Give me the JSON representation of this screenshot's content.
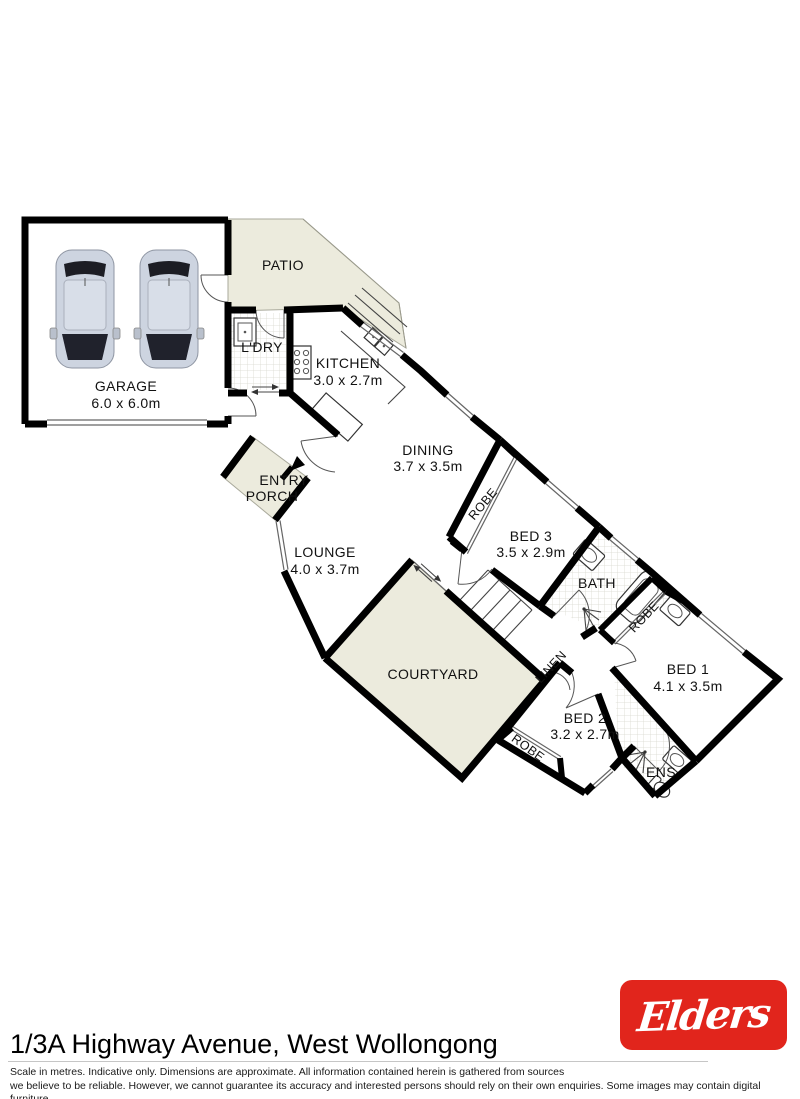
{
  "rooms": {
    "garage": {
      "name": "GARAGE",
      "dims": "6.0 x 6.0m"
    },
    "patio": {
      "name": "PATIO"
    },
    "laundry": {
      "name": "L'DRY"
    },
    "kitchen": {
      "name": "KITCHEN",
      "dims": "3.0 x 2.7m"
    },
    "dining": {
      "name": "DINING",
      "dims": "3.7 x 3.5m"
    },
    "entry_porch": {
      "line1": "ENTRY",
      "line2": "PORCH"
    },
    "lounge": {
      "name": "LOUNGE",
      "dims": "4.0 x 3.7m"
    },
    "courtyard": {
      "name": "COURTYARD"
    },
    "bed3": {
      "name": "BED 3",
      "dims": "3.5 x 2.9m"
    },
    "bath": {
      "name": "BATH"
    },
    "robe_bed3": {
      "name": "ROBE"
    },
    "robe_bed1": {
      "name": "ROBE"
    },
    "robe_bed2": {
      "name": "ROBE"
    },
    "linen": {
      "name": "LINEN"
    },
    "bed1": {
      "name": "BED 1",
      "dims": "4.1 x 3.5m"
    },
    "bed2": {
      "name": "BED 2",
      "dims": "3.2 x 2.7m"
    },
    "ensuite": {
      "name": "ENS"
    }
  },
  "icons": [
    "car",
    "laundry-sink",
    "stove",
    "kitchen-sink",
    "kitchen-bench",
    "bathtub",
    "shower",
    "vanity",
    "toilet",
    "stairs",
    "entry-arrow",
    "sliding-door-arrows"
  ],
  "footer": {
    "address": "1/3A Highway Avenue, West Wollongong",
    "disclaimer_line1": "Scale in metres. Indicative only. Dimensions are approximate. All information contained herein is gathered from sources",
    "disclaimer_line2": "we believe to be reliable. However, we cannot guarantee its accuracy and interested persons should rely on their own enquiries. Some images may contain digital furniture.",
    "brand": "Elders"
  },
  "colors": {
    "outdoor": "#ecebdd",
    "wall": "#000000",
    "brand_red": "#e1251c",
    "tile_grid": "#d9d9cf"
  }
}
